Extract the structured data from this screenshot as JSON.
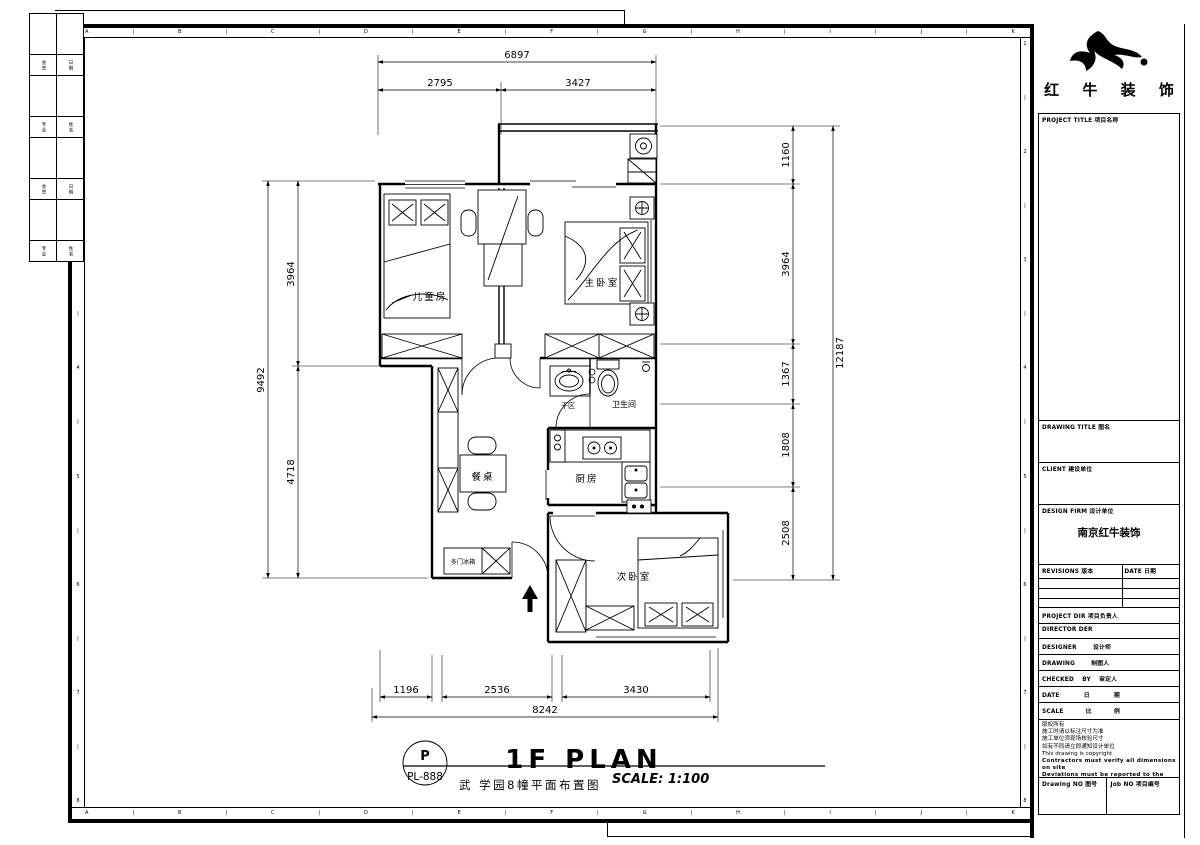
{
  "sheet": {
    "grid_letters": [
      "A",
      "B",
      "C",
      "D",
      "E",
      "F",
      "G",
      "H",
      "I",
      "J",
      "K"
    ],
    "row_numbers": [
      "1",
      "2",
      "3",
      "4",
      "5",
      "6",
      "7",
      "8"
    ],
    "sign_strip": [
      [
        "会签",
        "日期"
      ],
      [
        "专业",
        "姓名"
      ],
      [
        "会签",
        "日期"
      ],
      [
        "专业",
        "姓名"
      ]
    ]
  },
  "plan": {
    "rooms": {
      "children": "儿童房",
      "master": "主卧室",
      "bath": "卫生间",
      "dry": "干区",
      "kitchen": "厨房",
      "dining": "餐桌",
      "fridge": "多门冰箱",
      "second": "次卧室"
    },
    "dims": {
      "top_total": "6897",
      "top_left": "2795",
      "top_right": "3427",
      "left_total": "9492",
      "left_upper": "3964",
      "left_lower": "4718",
      "right_total": "12187",
      "right_1": "1160",
      "right_2": "3964",
      "right_3": "1367",
      "right_4": "1808",
      "right_5": "2508",
      "bottom_1": "1196",
      "bottom_2": "2536",
      "bottom_3": "3430",
      "bottom_total": "8242"
    },
    "title": {
      "stamp_top": "P",
      "stamp_code": "PL-888",
      "main": "1F PLAN",
      "sub": "武 学园8幢平面布置图",
      "scale": "SCALE: 1:100"
    }
  },
  "title_block": {
    "brand": "红 牛 装 饰",
    "fields": {
      "project_title": "PROJECT TITLE 项目名称",
      "drawing_title": "DRAWING TITLE 图名",
      "client": "CLIENT 建设单位",
      "design_firm": "DESIGN FIRM 设计单位",
      "design_firm_value": "南京红牛装饰",
      "revisions": "REVISIONS 版本",
      "date_col": "DATE 日期",
      "project_dir": "PROJECT DIR 项目负责人",
      "director": "DIRECTOR DER",
      "designer": "DESIGNER 设计师",
      "drawing_by": "DRAWING 制图人",
      "checked_by": "CHECKED BY 审定人",
      "date": "DATE 日 期",
      "scale": "SCALE 比 例",
      "drawing_no": "Drawing NO 图号",
      "job_no": "Job NO 项目编号"
    },
    "notes": [
      "版权所有",
      "施工时请以标注尺寸为准",
      "施工单位须现场核验尺寸",
      "如有不同请立即通知设计单位",
      "This drawing is copyright",
      "Contractors must verify all dimensions on site",
      "Deviations must be reported to the designer",
      "before proceeding with the works"
    ]
  }
}
